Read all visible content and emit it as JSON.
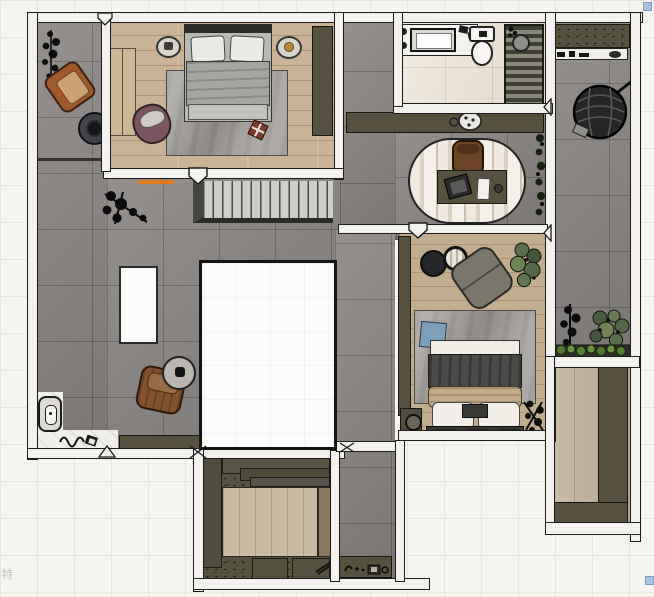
{
  "watermark": "特",
  "palette": {
    "backdrop": "#f5f4f1",
    "grid_line": "#e6e5e1",
    "wall_fill": "#f2f1ee",
    "wall_line": "#1b1b1b",
    "tile_gray": "#8a8683",
    "wood_light": "#c9b394",
    "wood_2": "#c2ad8f",
    "wood_3": "#cbbaa2",
    "wood_4": "#bfb098",
    "marble_bath": "#eae2d4",
    "marble_entry": "#f0efeb",
    "olive": "#57523f",
    "olive_dark": "#4e4a39",
    "olive_line": "#181611",
    "rug_gray": "#a09c98",
    "accent_orange": "#e07820",
    "handle_blue": "#a9c3de"
  },
  "objects": [
    "master-bedroom-double-bed",
    "nightstands",
    "wardrobe",
    "dresser",
    "mauve-armchair",
    "terrace-leather-armchair",
    "plants",
    "stairs",
    "floor-opening",
    "skylight-opening",
    "hall-leather-armchair",
    "side-tables",
    "entry-wall-fixture",
    "bathroom-vanity",
    "toilet",
    "shower",
    "hall-sideboard",
    "study-desk",
    "desk-chair",
    "laptop",
    "hanging-egg-chair",
    "balcony-planters",
    "secondary-bedroom-bed",
    "gray-armchair",
    "blue-cushion",
    "walk-in-closet-wardrobes",
    "laundry-cabinets",
    "corridor-console"
  ]
}
